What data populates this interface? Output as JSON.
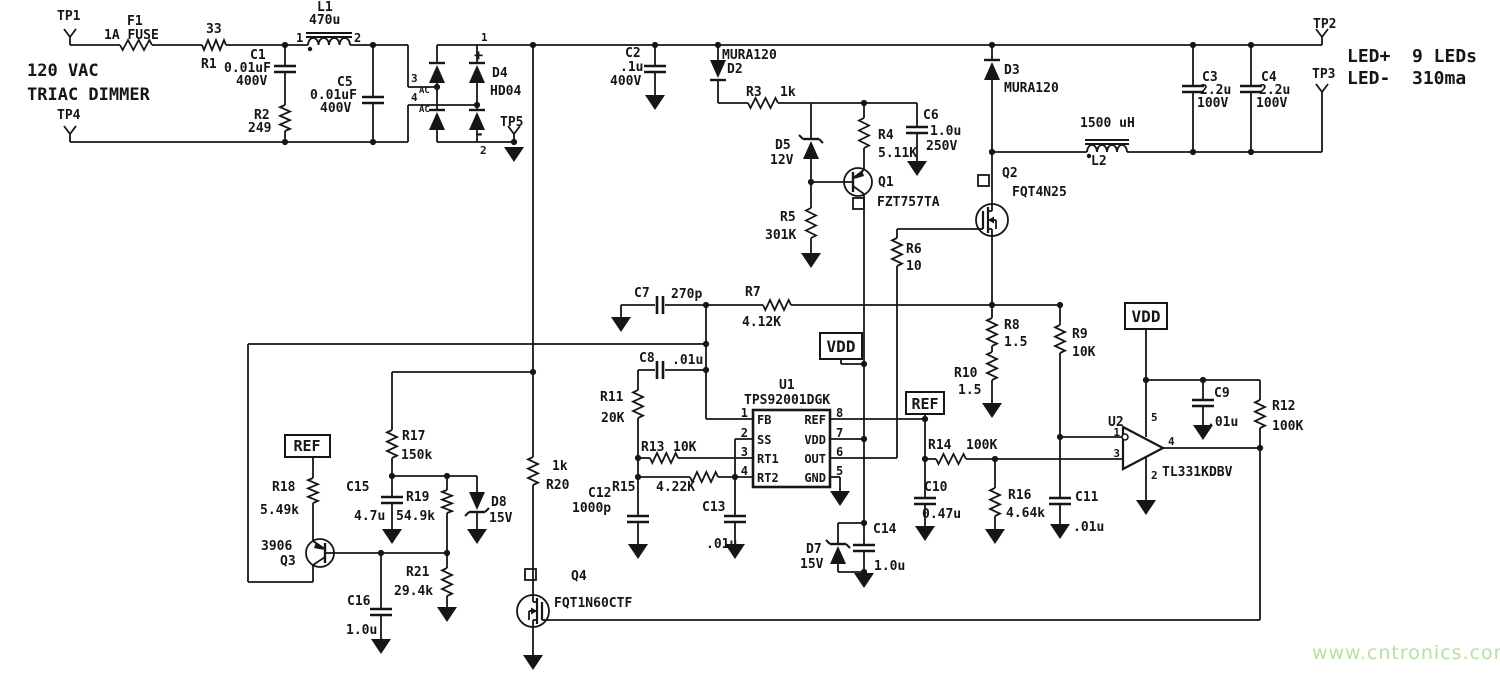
{
  "title": {
    "line1": "120 VAC",
    "line2": "TRIAC DIMMER"
  },
  "output": {
    "positive": "LED+",
    "load": "9 LEDs",
    "negative": "LED-",
    "current": "310ma"
  },
  "watermark": {
    "text": "www.cntronics.com",
    "color": "#b9e0a0"
  },
  "colors": {
    "wire": "#161616",
    "background": "#ffffff"
  },
  "nets": [
    "VDD",
    "REF"
  ],
  "test_points": [
    "TP1",
    "TP2",
    "TP3",
    "TP4",
    "TP5"
  ],
  "ics": [
    {
      "ref": "U1",
      "part": "TPS92001DGK",
      "pins_left": [
        "FB",
        "SS",
        "RT1",
        "RT2"
      ],
      "pin_numbers_left": [
        "1",
        "2",
        "3",
        "4"
      ],
      "pins_right": [
        "REF",
        "VDD",
        "OUT",
        "GND"
      ],
      "pin_numbers_right": [
        "8",
        "7",
        "6",
        "5"
      ]
    },
    {
      "ref": "U2",
      "part": "TL331KDBV",
      "pin_numbers": [
        "1",
        "3",
        "5",
        "2",
        "4"
      ]
    }
  ],
  "parts": [
    {
      "ref": "F1",
      "value": "1A FUSE"
    },
    {
      "ref": "R1",
      "value": "33"
    },
    {
      "ref": "C1",
      "value": "0.01uF 400V"
    },
    {
      "ref": "R2",
      "value": "249"
    },
    {
      "ref": "L1",
      "value": "470u"
    },
    {
      "ref": "C5",
      "value": "0.01uF 400V"
    },
    {
      "ref": "D4",
      "value": "HD04"
    },
    {
      "ref": "C2",
      "value": ".1u 400V"
    },
    {
      "ref": "D2",
      "value": "MURA120"
    },
    {
      "ref": "R3",
      "value": "1k"
    },
    {
      "ref": "D5",
      "value": "12V"
    },
    {
      "ref": "R4",
      "value": "5.11K"
    },
    {
      "ref": "C6",
      "value": "1.0u 250V"
    },
    {
      "ref": "Q1",
      "value": "FZT757TA"
    },
    {
      "ref": "R5",
      "value": "301K"
    },
    {
      "ref": "R6",
      "value": "10"
    },
    {
      "ref": "Q2",
      "value": "FQT4N25"
    },
    {
      "ref": "D3",
      "value": "MURA120"
    },
    {
      "ref": "L2",
      "value": "1500 uH"
    },
    {
      "ref": "C3",
      "value": "2.2u 100V"
    },
    {
      "ref": "C4",
      "value": "2.2u 100V"
    },
    {
      "ref": "C7",
      "value": "270p"
    },
    {
      "ref": "R7",
      "value": "4.12K"
    },
    {
      "ref": "C8",
      "value": ".01u"
    },
    {
      "ref": "R11",
      "value": "20K"
    },
    {
      "ref": "R13",
      "value": "10K"
    },
    {
      "ref": "R15",
      "value": "4.22K"
    },
    {
      "ref": "C12",
      "value": "1000p"
    },
    {
      "ref": "C13",
      "value": ".01u"
    },
    {
      "ref": "R8",
      "value": "1.5"
    },
    {
      "ref": "R9",
      "value": "10K"
    },
    {
      "ref": "R10",
      "value": "1.5"
    },
    {
      "ref": "R14",
      "value": "100K"
    },
    {
      "ref": "C10",
      "value": "0.47u"
    },
    {
      "ref": "R16",
      "value": "4.64k"
    },
    {
      "ref": "C11",
      "value": ".01u"
    },
    {
      "ref": "C9",
      "value": ".01u"
    },
    {
      "ref": "R12",
      "value": "100K"
    },
    {
      "ref": "D7",
      "value": "15V"
    },
    {
      "ref": "C14",
      "value": "1.0u"
    },
    {
      "ref": "Q4",
      "value": "FQT1N60CTF"
    },
    {
      "ref": "R20",
      "value": "1k"
    },
    {
      "ref": "R17",
      "value": "150k"
    },
    {
      "ref": "C15",
      "value": "4.7u"
    },
    {
      "ref": "R19",
      "value": "54.9k"
    },
    {
      "ref": "D8",
      "value": "15V"
    },
    {
      "ref": "Q3",
      "value": "3906"
    },
    {
      "ref": "R18",
      "value": "5.49k"
    },
    {
      "ref": "R21",
      "value": "29.4k"
    },
    {
      "ref": "C16",
      "value": "1.0u"
    }
  ],
  "labels": [
    {
      "id": "tp1",
      "t": "TP1",
      "x": 57,
      "y": 20,
      "s": 13
    },
    {
      "id": "f1",
      "t": "F1",
      "x": 127,
      "y": 25,
      "s": 13
    },
    {
      "id": "f1v",
      "t": "1A FUSE",
      "x": 104,
      "y": 39,
      "s": 13
    },
    {
      "id": "r1v",
      "t": "33",
      "x": 206,
      "y": 33,
      "s": 13
    },
    {
      "id": "r1",
      "t": "R1",
      "x": 201,
      "y": 68,
      "s": 13
    },
    {
      "id": "ttl1",
      "t": "120 VAC",
      "x": 27,
      "y": 76,
      "s": 17
    },
    {
      "id": "ttl2",
      "t": "TRIAC DIMMER",
      "x": 27,
      "y": 100,
      "s": 17
    },
    {
      "id": "tp4",
      "t": "TP4",
      "x": 57,
      "y": 119,
      "s": 13
    },
    {
      "id": "c1",
      "t": "C1",
      "x": 250,
      "y": 59,
      "s": 13
    },
    {
      "id": "c1v",
      "t": "0.01uF",
      "x": 224,
      "y": 72,
      "s": 13
    },
    {
      "id": "c1vv",
      "t": "400V",
      "x": 236,
      "y": 85,
      "s": 13
    },
    {
      "id": "r2",
      "t": "R2",
      "x": 254,
      "y": 119,
      "s": 13
    },
    {
      "id": "r2v",
      "t": "249",
      "x": 248,
      "y": 132,
      "s": 13
    },
    {
      "id": "l1",
      "t": "L1",
      "x": 317,
      "y": 11,
      "s": 13
    },
    {
      "id": "l1v",
      "t": "470u",
      "x": 309,
      "y": 24,
      "s": 13
    },
    {
      "id": "l1p1",
      "t": "1",
      "x": 296,
      "y": 42,
      "s": 12
    },
    {
      "id": "l1p2",
      "t": "2",
      "x": 354,
      "y": 42,
      "s": 12
    },
    {
      "id": "c5",
      "t": "C5",
      "x": 337,
      "y": 86,
      "s": 13
    },
    {
      "id": "c5v",
      "t": "0.01uF",
      "x": 310,
      "y": 99,
      "s": 13
    },
    {
      "id": "c5vv",
      "t": "400V",
      "x": 320,
      "y": 112,
      "s": 13
    },
    {
      "id": "bp3",
      "t": "3",
      "x": 411,
      "y": 82,
      "s": 11
    },
    {
      "id": "bac1",
      "t": "AC",
      "x": 419,
      "y": 93,
      "s": 9
    },
    {
      "id": "bp4",
      "t": "4",
      "x": 411,
      "y": 101,
      "s": 11
    },
    {
      "id": "bac2",
      "t": "AC",
      "x": 419,
      "y": 112,
      "s": 9
    },
    {
      "id": "bp1",
      "t": "1",
      "x": 481,
      "y": 41,
      "s": 11
    },
    {
      "id": "bplus",
      "t": "+",
      "x": 474,
      "y": 60,
      "s": 15
    },
    {
      "id": "d4",
      "t": "D4",
      "x": 492,
      "y": 77,
      "s": 13
    },
    {
      "id": "d4v",
      "t": "HD04",
      "x": 490,
      "y": 95,
      "s": 13
    },
    {
      "id": "bminus",
      "t": "-",
      "x": 475,
      "y": 139,
      "s": 15
    },
    {
      "id": "bp2",
      "t": "2",
      "x": 480,
      "y": 154,
      "s": 11
    },
    {
      "id": "tp5",
      "t": "TP5",
      "x": 500,
      "y": 126,
      "s": 13
    },
    {
      "id": "c2",
      "t": "C2",
      "x": 625,
      "y": 57,
      "s": 13
    },
    {
      "id": "c2v",
      "t": ".1u",
      "x": 620,
      "y": 71,
      "s": 13
    },
    {
      "id": "c2vv",
      "t": "400V",
      "x": 610,
      "y": 85,
      "s": 13
    },
    {
      "id": "d2v",
      "t": "MURA120",
      "x": 722,
      "y": 59,
      "s": 13
    },
    {
      "id": "d2",
      "t": "D2",
      "x": 727,
      "y": 73,
      "s": 13
    },
    {
      "id": "r3",
      "t": "R3",
      "x": 746,
      "y": 96,
      "s": 13
    },
    {
      "id": "r3v",
      "t": "1k",
      "x": 780,
      "y": 96,
      "s": 13
    },
    {
      "id": "d5",
      "t": "D5",
      "x": 775,
      "y": 149,
      "s": 13
    },
    {
      "id": "d5v",
      "t": "12V",
      "x": 770,
      "y": 164,
      "s": 13
    },
    {
      "id": "r4",
      "t": "R4",
      "x": 878,
      "y": 139,
      "s": 13
    },
    {
      "id": "r4v",
      "t": "5.11K",
      "x": 878,
      "y": 157,
      "s": 13
    },
    {
      "id": "c6",
      "t": "C6",
      "x": 923,
      "y": 119,
      "s": 13
    },
    {
      "id": "c6v",
      "t": "1.0u",
      "x": 930,
      "y": 135,
      "s": 13
    },
    {
      "id": "c6vv",
      "t": "250V",
      "x": 926,
      "y": 150,
      "s": 13
    },
    {
      "id": "q1",
      "t": "Q1",
      "x": 878,
      "y": 186,
      "s": 13
    },
    {
      "id": "q1v",
      "t": "FZT757TA",
      "x": 877,
      "y": 206,
      "s": 13
    },
    {
      "id": "r5",
      "t": "R5",
      "x": 780,
      "y": 221,
      "s": 13
    },
    {
      "id": "r5v",
      "t": "301K",
      "x": 765,
      "y": 239,
      "s": 13
    },
    {
      "id": "d3",
      "t": "D3",
      "x": 1004,
      "y": 74,
      "s": 13
    },
    {
      "id": "d3v",
      "t": "MURA120",
      "x": 1004,
      "y": 92,
      "s": 13
    },
    {
      "id": "q2",
      "t": "Q2",
      "x": 1002,
      "y": 177,
      "s": 13
    },
    {
      "id": "q2v",
      "t": "FQT4N25",
      "x": 1012,
      "y": 196,
      "s": 13
    },
    {
      "id": "r6",
      "t": "R6",
      "x": 906,
      "y": 253,
      "s": 13
    },
    {
      "id": "r6v",
      "t": "10",
      "x": 906,
      "y": 270,
      "s": 13
    },
    {
      "id": "l2v",
      "t": "1500 uH",
      "x": 1080,
      "y": 127,
      "s": 13
    },
    {
      "id": "l2",
      "t": "L2",
      "x": 1091,
      "y": 165,
      "s": 13
    },
    {
      "id": "tp2",
      "t": "TP2",
      "x": 1313,
      "y": 28,
      "s": 13
    },
    {
      "id": "tp3",
      "t": "TP3",
      "x": 1312,
      "y": 78,
      "s": 13
    },
    {
      "id": "ledp",
      "t": "LED+",
      "x": 1347,
      "y": 62,
      "s": 18
    },
    {
      "id": "ledn",
      "t": "9 LEDs",
      "x": 1412,
      "y": 62,
      "s": 18
    },
    {
      "id": "ledm",
      "t": "LED-",
      "x": 1347,
      "y": 84,
      "s": 18
    },
    {
      "id": "ledc",
      "t": "310ma",
      "x": 1412,
      "y": 84,
      "s": 18
    },
    {
      "id": "c3",
      "t": "C3",
      "x": 1202,
      "y": 81,
      "s": 13
    },
    {
      "id": "c3v",
      "t": "2.2u",
      "x": 1200,
      "y": 94,
      "s": 13
    },
    {
      "id": "c3vv",
      "t": "100V",
      "x": 1197,
      "y": 107,
      "s": 13
    },
    {
      "id": "c4",
      "t": "C4",
      "x": 1261,
      "y": 81,
      "s": 13
    },
    {
      "id": "c4v",
      "t": "2.2u",
      "x": 1259,
      "y": 94,
      "s": 13
    },
    {
      "id": "c4vv",
      "t": "100V",
      "x": 1256,
      "y": 107,
      "s": 13
    },
    {
      "id": "c7",
      "t": "C7",
      "x": 634,
      "y": 297,
      "s": 13
    },
    {
      "id": "c7v",
      "t": "270p",
      "x": 671,
      "y": 298,
      "s": 13
    },
    {
      "id": "r7",
      "t": "R7",
      "x": 745,
      "y": 296,
      "s": 13
    },
    {
      "id": "r7v",
      "t": "4.12K",
      "x": 742,
      "y": 326,
      "s": 13
    },
    {
      "id": "c8",
      "t": "C8",
      "x": 639,
      "y": 362,
      "s": 13
    },
    {
      "id": "c8v",
      "t": ".01u",
      "x": 672,
      "y": 364,
      "s": 13
    },
    {
      "id": "r11",
      "t": "R11",
      "x": 600,
      "y": 401,
      "s": 13
    },
    {
      "id": "r11v",
      "t": "20K",
      "x": 601,
      "y": 422,
      "s": 13
    },
    {
      "id": "vdd1",
      "t": "VDD",
      "x": 841,
      "y": 352,
      "s": 16,
      "a": "middle"
    },
    {
      "id": "u1",
      "t": "U1",
      "x": 779,
      "y": 389,
      "s": 13
    },
    {
      "id": "u1v",
      "t": "TPS92001DGK",
      "x": 744,
      "y": 404,
      "s": 13
    },
    {
      "id": "fb",
      "t": "FB",
      "x": 757,
      "y": 424,
      "s": 12
    },
    {
      "id": "ss",
      "t": "SS",
      "x": 757,
      "y": 444,
      "s": 12
    },
    {
      "id": "rt1",
      "t": "RT1",
      "x": 757,
      "y": 463,
      "s": 12
    },
    {
      "id": "rt2",
      "t": "RT2",
      "x": 757,
      "y": 482,
      "s": 12
    },
    {
      "id": "refp",
      "t": "REF",
      "x": 826,
      "y": 424,
      "s": 12,
      "a": "end"
    },
    {
      "id": "vddp",
      "t": "VDD",
      "x": 826,
      "y": 444,
      "s": 12,
      "a": "end"
    },
    {
      "id": "outp",
      "t": "OUT",
      "x": 826,
      "y": 463,
      "s": 12,
      "a": "end"
    },
    {
      "id": "gndp",
      "t": "GND",
      "x": 826,
      "y": 482,
      "s": 12,
      "a": "end"
    },
    {
      "id": "u1n1",
      "t": "1",
      "x": 748,
      "y": 417,
      "s": 12,
      "a": "end"
    },
    {
      "id": "u1n2",
      "t": "2",
      "x": 748,
      "y": 437,
      "s": 12,
      "a": "end"
    },
    {
      "id": "u1n3",
      "t": "3",
      "x": 748,
      "y": 456,
      "s": 12,
      "a": "end"
    },
    {
      "id": "u1n4",
      "t": "4",
      "x": 748,
      "y": 475,
      "s": 12,
      "a": "end"
    },
    {
      "id": "u1n8",
      "t": "8",
      "x": 836,
      "y": 417,
      "s": 12
    },
    {
      "id": "u1n7",
      "t": "7",
      "x": 836,
      "y": 437,
      "s": 12
    },
    {
      "id": "u1n6",
      "t": "6",
      "x": 836,
      "y": 456,
      "s": 12
    },
    {
      "id": "u1n5",
      "t": "5",
      "x": 836,
      "y": 475,
      "s": 12
    },
    {
      "id": "r13",
      "t": "R13",
      "x": 641,
      "y": 451,
      "s": 13
    },
    {
      "id": "r13v",
      "t": "10K",
      "x": 673,
      "y": 451,
      "s": 13
    },
    {
      "id": "r15",
      "t": "R15",
      "x": 612,
      "y": 491,
      "s": 13
    },
    {
      "id": "r15v",
      "t": "4.22K",
      "x": 656,
      "y": 491,
      "s": 13
    },
    {
      "id": "c12",
      "t": "C12",
      "x": 588,
      "y": 497,
      "s": 13
    },
    {
      "id": "c12v",
      "t": "1000p",
      "x": 572,
      "y": 512,
      "s": 13
    },
    {
      "id": "c13",
      "t": "C13",
      "x": 702,
      "y": 511,
      "s": 13
    },
    {
      "id": "c13v",
      "t": ".01u",
      "x": 706,
      "y": 548,
      "s": 13
    },
    {
      "id": "ref2",
      "t": "REF",
      "x": 925,
      "y": 409,
      "s": 15,
      "a": "middle"
    },
    {
      "id": "r14",
      "t": "R14",
      "x": 928,
      "y": 449,
      "s": 13
    },
    {
      "id": "r14v",
      "t": "100K",
      "x": 966,
      "y": 449,
      "s": 13
    },
    {
      "id": "r8",
      "t": "R8",
      "x": 1004,
      "y": 329,
      "s": 13
    },
    {
      "id": "r8v",
      "t": "1.5",
      "x": 1004,
      "y": 346,
      "s": 13
    },
    {
      "id": "r9",
      "t": "R9",
      "x": 1072,
      "y": 338,
      "s": 13
    },
    {
      "id": "r9v",
      "t": "10K",
      "x": 1072,
      "y": 356,
      "s": 13
    },
    {
      "id": "r10",
      "t": "R10",
      "x": 954,
      "y": 377,
      "s": 13
    },
    {
      "id": "r10v",
      "t": "1.5",
      "x": 958,
      "y": 394,
      "s": 13
    },
    {
      "id": "vdd2",
      "t": "VDD",
      "x": 1146,
      "y": 322,
      "s": 16,
      "a": "middle"
    },
    {
      "id": "c10",
      "t": "C10",
      "x": 924,
      "y": 491,
      "s": 13
    },
    {
      "id": "c10v",
      "t": "0.47u",
      "x": 922,
      "y": 518,
      "s": 13
    },
    {
      "id": "r16",
      "t": "R16",
      "x": 1008,
      "y": 499,
      "s": 13
    },
    {
      "id": "r16v",
      "t": "4.64k",
      "x": 1006,
      "y": 517,
      "s": 13
    },
    {
      "id": "c11",
      "t": "C11",
      "x": 1075,
      "y": 501,
      "s": 13
    },
    {
      "id": "c11v",
      "t": ".01u",
      "x": 1073,
      "y": 531,
      "s": 13
    },
    {
      "id": "u2",
      "t": "U2",
      "x": 1108,
      "y": 426,
      "s": 13
    },
    {
      "id": "u2v",
      "t": "TL331KDBV",
      "x": 1162,
      "y": 476,
      "s": 13
    },
    {
      "id": "u2n1",
      "t": "1",
      "x": 1120,
      "y": 436,
      "s": 11,
      "a": "end"
    },
    {
      "id": "u2n3",
      "t": "3",
      "x": 1120,
      "y": 457,
      "s": 11,
      "a": "end"
    },
    {
      "id": "u2n5",
      "t": "5",
      "x": 1151,
      "y": 421,
      "s": 11
    },
    {
      "id": "u2n2",
      "t": "2",
      "x": 1151,
      "y": 479,
      "s": 11
    },
    {
      "id": "u2n4",
      "t": "4",
      "x": 1168,
      "y": 445,
      "s": 11
    },
    {
      "id": "c9",
      "t": "C9",
      "x": 1214,
      "y": 397,
      "s": 13
    },
    {
      "id": "c9v",
      "t": ".01u",
      "x": 1207,
      "y": 426,
      "s": 13
    },
    {
      "id": "r12",
      "t": "R12",
      "x": 1272,
      "y": 410,
      "s": 13
    },
    {
      "id": "r12v",
      "t": "100K",
      "x": 1272,
      "y": 430,
      "s": 13
    },
    {
      "id": "d7",
      "t": "D7",
      "x": 806,
      "y": 553,
      "s": 13
    },
    {
      "id": "d7v",
      "t": "15V",
      "x": 800,
      "y": 568,
      "s": 13
    },
    {
      "id": "c14",
      "t": "C14",
      "x": 873,
      "y": 533,
      "s": 13
    },
    {
      "id": "c14v",
      "t": "1.0u",
      "x": 874,
      "y": 570,
      "s": 13
    },
    {
      "id": "q4",
      "t": "Q4",
      "x": 571,
      "y": 580,
      "s": 13
    },
    {
      "id": "q4v",
      "t": "FQT1N60CTF",
      "x": 554,
      "y": 607,
      "s": 13
    },
    {
      "id": "r20v",
      "t": "1k",
      "x": 552,
      "y": 470,
      "s": 13
    },
    {
      "id": "r20",
      "t": "R20",
      "x": 546,
      "y": 489,
      "s": 13
    },
    {
      "id": "ref1",
      "t": "REF",
      "x": 307,
      "y": 451,
      "s": 15,
      "a": "middle"
    },
    {
      "id": "r18",
      "t": "R18",
      "x": 272,
      "y": 491,
      "s": 13
    },
    {
      "id": "r18v",
      "t": "5.49k",
      "x": 260,
      "y": 514,
      "s": 13
    },
    {
      "id": "q3v",
      "t": "3906",
      "x": 261,
      "y": 550,
      "s": 13
    },
    {
      "id": "q3",
      "t": "Q3",
      "x": 280,
      "y": 565,
      "s": 13
    },
    {
      "id": "r17",
      "t": "R17",
      "x": 402,
      "y": 440,
      "s": 13
    },
    {
      "id": "r17v",
      "t": "150k",
      "x": 401,
      "y": 459,
      "s": 13
    },
    {
      "id": "c15",
      "t": "C15",
      "x": 346,
      "y": 491,
      "s": 13
    },
    {
      "id": "c15v",
      "t": "4.7u",
      "x": 354,
      "y": 520,
      "s": 13
    },
    {
      "id": "r19",
      "t": "R19",
      "x": 406,
      "y": 501,
      "s": 13
    },
    {
      "id": "r19v",
      "t": "54.9k",
      "x": 396,
      "y": 520,
      "s": 13
    },
    {
      "id": "d8",
      "t": "D8",
      "x": 491,
      "y": 506,
      "s": 13
    },
    {
      "id": "d8v",
      "t": "15V",
      "x": 489,
      "y": 522,
      "s": 13
    },
    {
      "id": "r21",
      "t": "R21",
      "x": 406,
      "y": 576,
      "s": 13
    },
    {
      "id": "r21v",
      "t": "29.4k",
      "x": 394,
      "y": 595,
      "s": 13
    },
    {
      "id": "c16",
      "t": "C16",
      "x": 347,
      "y": 605,
      "s": 13
    },
    {
      "id": "c16v",
      "t": "1.0u",
      "x": 346,
      "y": 634,
      "s": 13
    }
  ]
}
